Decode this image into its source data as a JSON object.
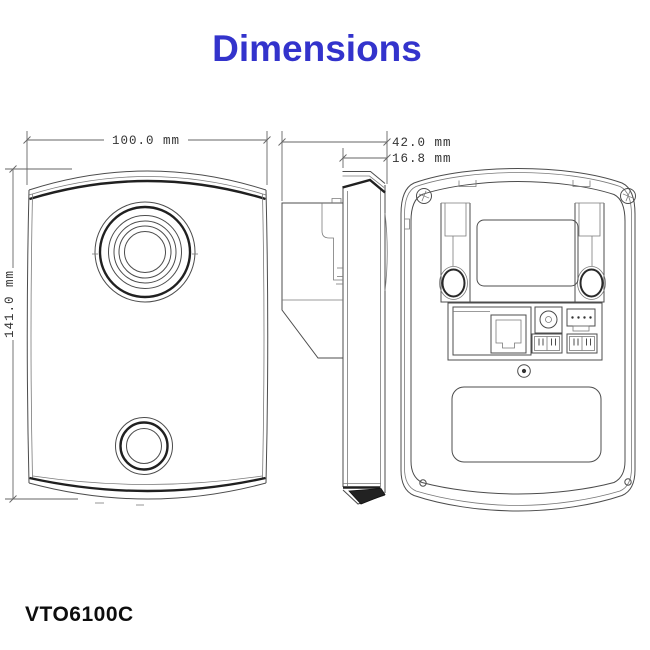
{
  "title": "Dimensions",
  "model": "VTO6100C",
  "dimensions": {
    "width_label": "100.0 mm",
    "height_label": "141.0 mm",
    "depth_label": "42.0 mm",
    "panel_depth_label": "16.8 mm"
  },
  "colors": {
    "title_blue": "#3333cc",
    "line_gray": "#4c4c4c",
    "dark_edge": "#202020",
    "background": "#ffffff"
  }
}
